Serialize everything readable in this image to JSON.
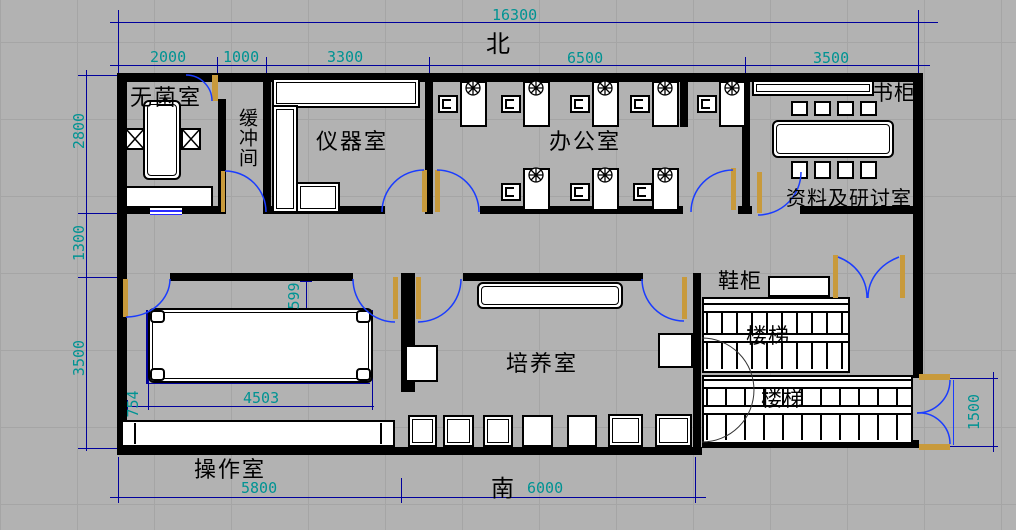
{
  "drawing": {
    "north": "北",
    "south": "南",
    "rooms": {
      "sterile": "无菌室",
      "buffer": "缓冲间",
      "instrument": "仪器室",
      "office": "办公室",
      "archive": "资料及研讨室",
      "culture": "培养室",
      "operation": "操作室"
    },
    "fixtures": {
      "bookcase": "书柜",
      "shoe_cabinet": "鞋柜",
      "stairs_upper": "楼梯",
      "stairs_lower": "楼梯"
    },
    "dims": {
      "total": "16300",
      "t2000": "2000",
      "t1000": "1000",
      "t3300": "3300",
      "t6500": "6500",
      "t3500": "3500",
      "l2800": "2800",
      "l1300": "1300",
      "l3500": "3500",
      "b5800": "5800",
      "b6000": "6000",
      "r1500": "1500",
      "i4503": "4503",
      "i754": "754",
      "i599": "599"
    },
    "colors": {
      "canvas": "#b2b2b2",
      "wall": "#000000",
      "dim_line": "#00009c",
      "dim_text": "#009393",
      "door_arc": "#1a3cff",
      "door_jamb": "#c89a3c"
    }
  }
}
